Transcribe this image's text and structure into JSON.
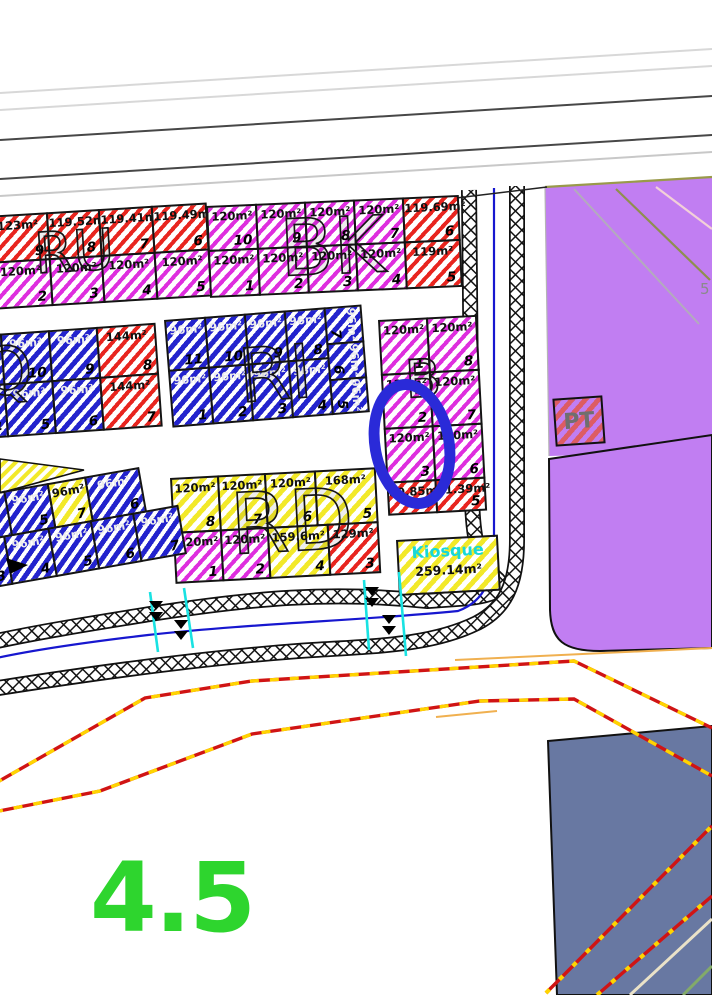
{
  "labels": {
    "pt": "PT",
    "five": "5",
    "zone": "4.5"
  },
  "colors": {
    "red": "#e8251f",
    "magenta": "#de2ede",
    "blue": "#2323cd",
    "yellow": "#f2e929",
    "purple": "#c17ef2",
    "slate": "#6878a2",
    "green_label": "#2ed52e",
    "cyan": "#19e2e2",
    "road_blue": "#1717cf",
    "dash_red": "#d01414",
    "dash_yellow": "#ffd400",
    "highlight_blue": "#2a2ad8",
    "orange": "#f0b050"
  },
  "blocks": [
    {
      "id": "ru",
      "letters": "RU",
      "lx": 46,
      "ly": 14,
      "ls": 56,
      "x": -14,
      "y": 216,
      "rot": -3.5,
      "rows": [
        {
          "y0": 0,
          "h": 48,
          "cells": [
            {
              "a": "123m²",
              "n": "9",
              "c": "red",
              "w": 62
            },
            {
              "a": "119.52m²",
              "n": "8",
              "c": "red",
              "w": 54
            },
            {
              "a": "119.41m²",
              "n": "7",
              "c": "red",
              "w": 55
            },
            {
              "a": "119.49m²",
              "n": "6",
              "c": "red",
              "w": 56
            }
          ]
        },
        {
          "y0": 46,
          "h": 48,
          "cells": [
            {
              "a": "120m²",
              "n": "2",
              "c": "mag",
              "w": 62
            },
            {
              "a": "120m²",
              "n": "3",
              "c": "mag",
              "w": 54
            },
            {
              "a": "120m²",
              "n": "4",
              "c": "mag",
              "w": 55
            },
            {
              "a": "120m²",
              "n": "5",
              "c": "mag",
              "w": 56
            }
          ]
        }
      ]
    },
    {
      "id": "bk",
      "letters": "BK",
      "lx": 72,
      "ly": 8,
      "ls": 78,
      "x": 206,
      "y": 206,
      "rot": -2.5,
      "rows": [
        {
          "y0": 0,
          "h": 46,
          "cells": [
            {
              "a": "120m²",
              "n": "10",
              "c": "mag",
              "w": 51
            },
            {
              "a": "120m²",
              "n": "9",
              "c": "mag",
              "w": 51
            },
            {
              "a": "120m²",
              "n": "8",
              "c": "mag",
              "w": 51
            },
            {
              "a": "120m²",
              "n": "7",
              "c": "mag",
              "w": 51
            },
            {
              "a": "119.69m²",
              "n": "6",
              "c": "red",
              "w": 57
            }
          ]
        },
        {
          "y0": 44,
          "h": 48,
          "cells": [
            {
              "a": "120m²",
              "n": "1",
              "c": "mag",
              "w": 51
            },
            {
              "a": "120m²",
              "n": "2",
              "c": "mag",
              "w": 51
            },
            {
              "a": "120m²",
              "n": "3",
              "c": "mag",
              "w": 51
            },
            {
              "a": "120m²",
              "n": "4",
              "c": "mag",
              "w": 51
            },
            {
              "a": "119m²",
              "n": "5",
              "c": "red",
              "w": 57
            }
          ]
        }
      ]
    },
    {
      "id": "lq",
      "letters": "Q",
      "lx": 40,
      "ly": 6,
      "ls": 66,
      "x": -62,
      "y": 338,
      "rot": -4,
      "rows": [
        {
          "y0": 0,
          "h": 52,
          "cells": [
            {
              "a": "96m²",
              "n": "11",
              "c": "blue",
              "w": 64
            },
            {
              "a": "96m²",
              "n": "10",
              "c": "blue",
              "w": 50
            },
            {
              "a": "96m²",
              "n": "9",
              "c": "blue",
              "w": 50
            },
            {
              "a": "144m²",
              "n": "8",
              "c": "red",
              "w": 60
            }
          ]
        },
        {
          "y0": 50,
          "h": 54,
          "cells": [
            {
              "a": "96m²",
              "n": "4",
              "c": "blue",
              "w": 64
            },
            {
              "a": "96m²",
              "n": "5",
              "c": "blue",
              "w": 50
            },
            {
              "a": "96m²",
              "n": "6",
              "c": "blue",
              "w": 50
            },
            {
              "a": "144m²",
              "n": "7",
              "c": "red",
              "w": 60
            }
          ]
        }
      ]
    },
    {
      "id": "ri",
      "letters": "RI",
      "lx": 70,
      "ly": 26,
      "ls": 74,
      "x": 164,
      "y": 320,
      "rot": -4.5,
      "rows": [
        {
          "y0": 0,
          "h": 52,
          "cells": [
            {
              "a": "96m²",
              "n": "11",
              "c": "blue",
              "w": 42
            },
            {
              "a": "96m²",
              "n": "10",
              "c": "blue",
              "w": 42
            },
            {
              "a": "96m²",
              "n": "9",
              "c": "blue",
              "w": 42
            },
            {
              "a": "96m²",
              "n": "8",
              "c": "blue",
              "w": 42
            }
          ]
        },
        {
          "y0": 50,
          "h": 58,
          "cells": [
            {
              "a": "96m²",
              "n": "1",
              "c": "blue",
              "w": 42
            },
            {
              "a": "96m²",
              "n": "2",
              "c": "blue",
              "w": 42
            },
            {
              "a": "96m²",
              "n": "3",
              "c": "blue",
              "w": 42
            },
            {
              "a": "96m²",
              "n": "4",
              "c": "blue",
              "w": 42
            }
          ]
        },
        {
          "y0": 0,
          "x0": 160,
          "h": 38,
          "cells": [
            {
              "a": "96m²",
              "n": "7",
              "c": "blue",
              "w": 38,
              "r": 1
            }
          ]
        },
        {
          "y0": 36,
          "x0": 160,
          "h": 38,
          "cells": [
            {
              "a": "96m²",
              "n": "6",
              "c": "blue",
              "w": 38,
              "r": 1
            }
          ]
        },
        {
          "y0": 72,
          "x0": 160,
          "h": 36,
          "cells": [
            {
              "a": "96m²",
              "n": "5",
              "c": "blue",
              "w": 38,
              "r": 1
            }
          ]
        }
      ]
    },
    {
      "id": "b",
      "letters": "B",
      "lx": 24,
      "ly": 36,
      "ls": 52,
      "x": 378,
      "y": 320,
      "rot": -3,
      "rows": [
        {
          "y0": 0,
          "h": 56,
          "cells": [
            {
              "a": "120m²",
              "n": "1",
              "c": "mag",
              "w": 50
            },
            {
              "a": "120m²",
              "n": "8",
              "c": "mag",
              "w": 51
            }
          ]
        },
        {
          "y0": 54,
          "h": 56,
          "cells": [
            {
              "a": "120m²",
              "n": "2",
              "c": "mag",
              "w": 50
            },
            {
              "a": "120m²",
              "n": "7",
              "c": "mag",
              "w": 51
            }
          ]
        },
        {
          "y0": 108,
          "h": 56,
          "cells": [
            {
              "a": "120m²",
              "n": "3",
              "c": "mag",
              "w": 50
            },
            {
              "a": "120m²",
              "n": "6",
              "c": "mag",
              "w": 51
            }
          ]
        },
        {
          "y0": 162,
          "h": 34,
          "cells": [
            {
              "a": "80.85m²",
              "n": "4",
              "c": "red",
              "w": 50
            },
            {
              "a": "81.39m²",
              "n": "5",
              "c": "red",
              "w": 51
            }
          ]
        }
      ]
    },
    {
      "id": "rd",
      "letters": "RD",
      "lx": 58,
      "ly": 8,
      "ls": 84,
      "x": 170,
      "y": 478,
      "rot": -3,
      "rows": [
        {
          "y0": 0,
          "h": 56,
          "cells": [
            {
              "a": "120m²",
              "n": "8",
              "c": "yel",
              "w": 49
            },
            {
              "a": "120m²",
              "n": "7",
              "c": "yel",
              "w": 49
            },
            {
              "a": "120m²",
              "n": "6",
              "c": "yel",
              "w": 52
            },
            {
              "a": "168m²",
              "n": "5",
              "c": "yel",
              "w": 62
            }
          ]
        },
        {
          "y0": 54,
          "h": 52,
          "cells": [
            {
              "a": "120m²",
              "n": "1",
              "c": "mag",
              "w": 49
            },
            {
              "a": "120m²",
              "n": "2",
              "c": "mag",
              "w": 49
            },
            {
              "a": "159.6m²",
              "n": "4",
              "c": "yel",
              "w": 62
            },
            {
              "a": "129m²",
              "n": "3",
              "c": "red",
              "w": 52
            }
          ]
        }
      ]
    },
    {
      "id": "kq",
      "x": 396,
      "y": 540,
      "rot": -3,
      "rows": [
        {
          "y0": 0,
          "h": 56,
          "cells": [
            {
              "a": "259.14m²",
              "n": "",
              "c": "yel",
              "w": 102,
              "t": "Kiosque"
            }
          ]
        }
      ]
    },
    {
      "id": "bl",
      "x": -48,
      "y": 500,
      "rot": -10,
      "rows": [
        {
          "y0": 0,
          "h": 46,
          "cells": [
            {
              "a": "96m²",
              "n": "",
              "c": "blue",
              "w": 54
            },
            {
              "a": "96m²",
              "n": "5",
              "c": "blue",
              "w": 46
            },
            {
              "a": "96m²",
              "n": "7",
              "c": "yel",
              "w": 40
            },
            {
              "a": "96m²",
              "n": "6",
              "c": "blue",
              "w": 56
            }
          ]
        },
        {
          "y0": 44,
          "x0": -6,
          "h": 50,
          "cells": [
            {
              "a": "96m²",
              "n": "3",
              "c": "blue",
              "w": 52
            },
            {
              "a": "96m²",
              "n": "4",
              "c": "blue",
              "w": 47
            },
            {
              "a": "96m²",
              "n": "5",
              "c": "blue",
              "w": 45
            },
            {
              "a": "96m²",
              "n": "6",
              "c": "blue",
              "w": 45
            },
            {
              "a": "96m²",
              "n": "7",
              "c": "blue",
              "w": 47
            }
          ]
        }
      ]
    }
  ]
}
